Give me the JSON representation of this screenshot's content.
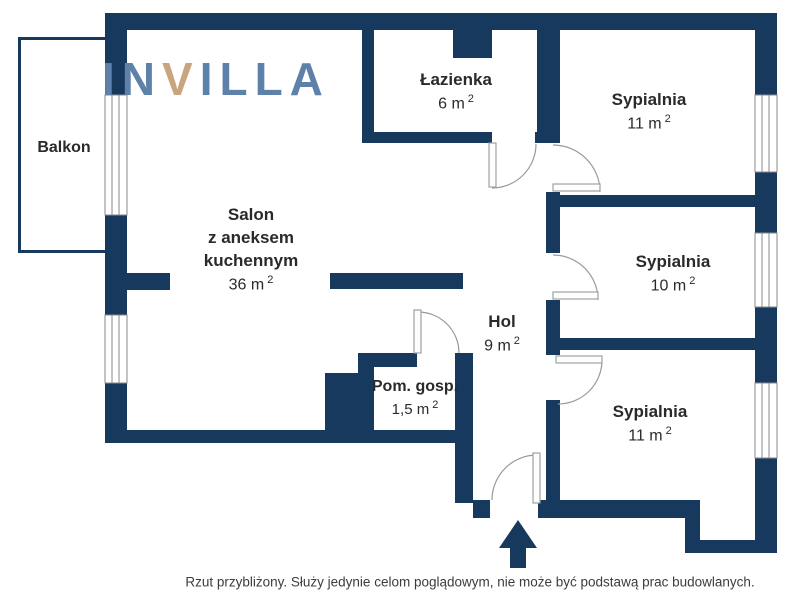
{
  "logo": {
    "part1": "IN",
    "part2": "V",
    "part3": "ILLA"
  },
  "rooms": {
    "balkon": {
      "name": "Balkon"
    },
    "salon": {
      "l1": "Salon",
      "l2": "z aneksem",
      "l3": "kuchennym",
      "area": "36 m",
      "sup": "2"
    },
    "lazienka": {
      "name": "Łazienka",
      "area": "6 m",
      "sup": "2"
    },
    "sypialnia1": {
      "name": "Sypialnia",
      "area": "11 m",
      "sup": "2"
    },
    "sypialnia2": {
      "name": "Sypialnia",
      "area": "10 m",
      "sup": "2"
    },
    "sypialnia3": {
      "name": "Sypialnia",
      "area": "11 m",
      "sup": "2"
    },
    "hol": {
      "name": "Hol",
      "area": "9 m",
      "sup": "2"
    },
    "pomgosp": {
      "name": "Pom. gosp.",
      "area": "1,5 m",
      "sup": "2"
    }
  },
  "disclaimer": "Rzut przybliżony. Służy jedynie celom poglądowym, nie może być podstawą prac budowlanych.",
  "colors": {
    "wall": "#17395e",
    "logo_blue": "#5d81a9",
    "logo_tan": "#c9a57e",
    "text": "#2a2a2a"
  }
}
